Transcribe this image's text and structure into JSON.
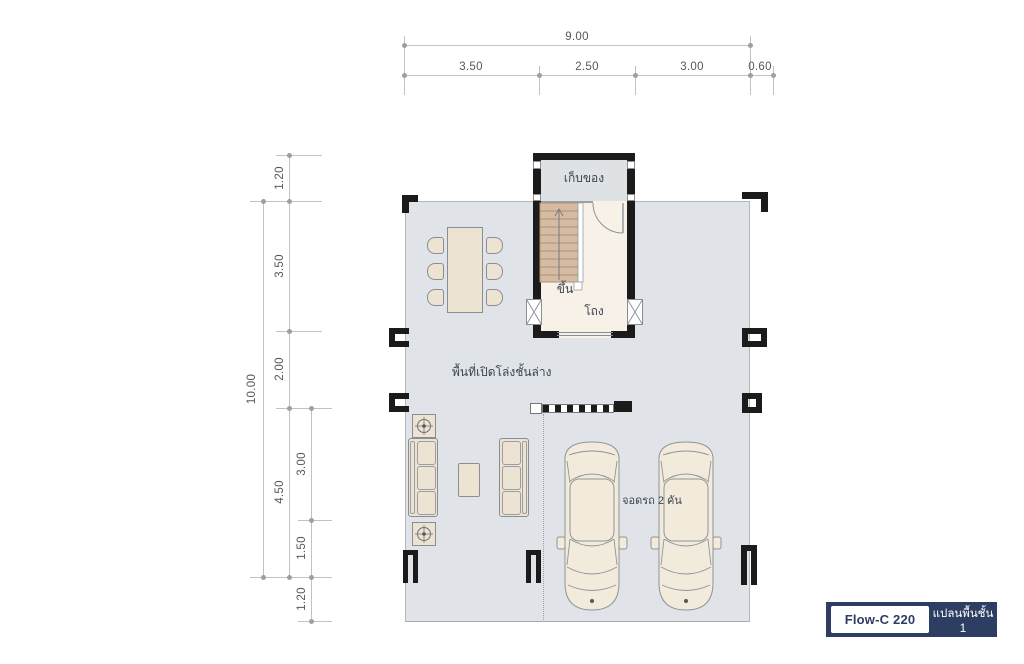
{
  "dimensions": {
    "top": {
      "total": "9.00",
      "segments": [
        "3.50",
        "2.50",
        "3.00",
        "0.60"
      ]
    },
    "left": {
      "total": "10.00",
      "outer_segments": [
        "1.20",
        "3.50",
        "2.00",
        "4.50"
      ],
      "inner_segments": [
        "3.00",
        "1.50",
        "1.20"
      ]
    }
  },
  "rooms": {
    "storage": "เก็บของ",
    "stair_up": "ขึ้น",
    "hall": "โถง",
    "open_area": "พื้นที่เปิดโล่งชั้นล่าง",
    "parking": "จอดรถ 2 คัน"
  },
  "legend": {
    "model": "Flow-C 220",
    "plan": "แปลนพื้นชั้น 1"
  },
  "colors": {
    "navy": "#2e3e63",
    "floor_fill": "#e0e4e8",
    "storage_fill": "#dfe2e5",
    "hall_fill": "#f8f1e7",
    "stair_fill": "#d5bba3",
    "furniture_fill": "#ece3d2",
    "car_fill": "#f2ebdb",
    "wall": "#1b1b1b"
  }
}
